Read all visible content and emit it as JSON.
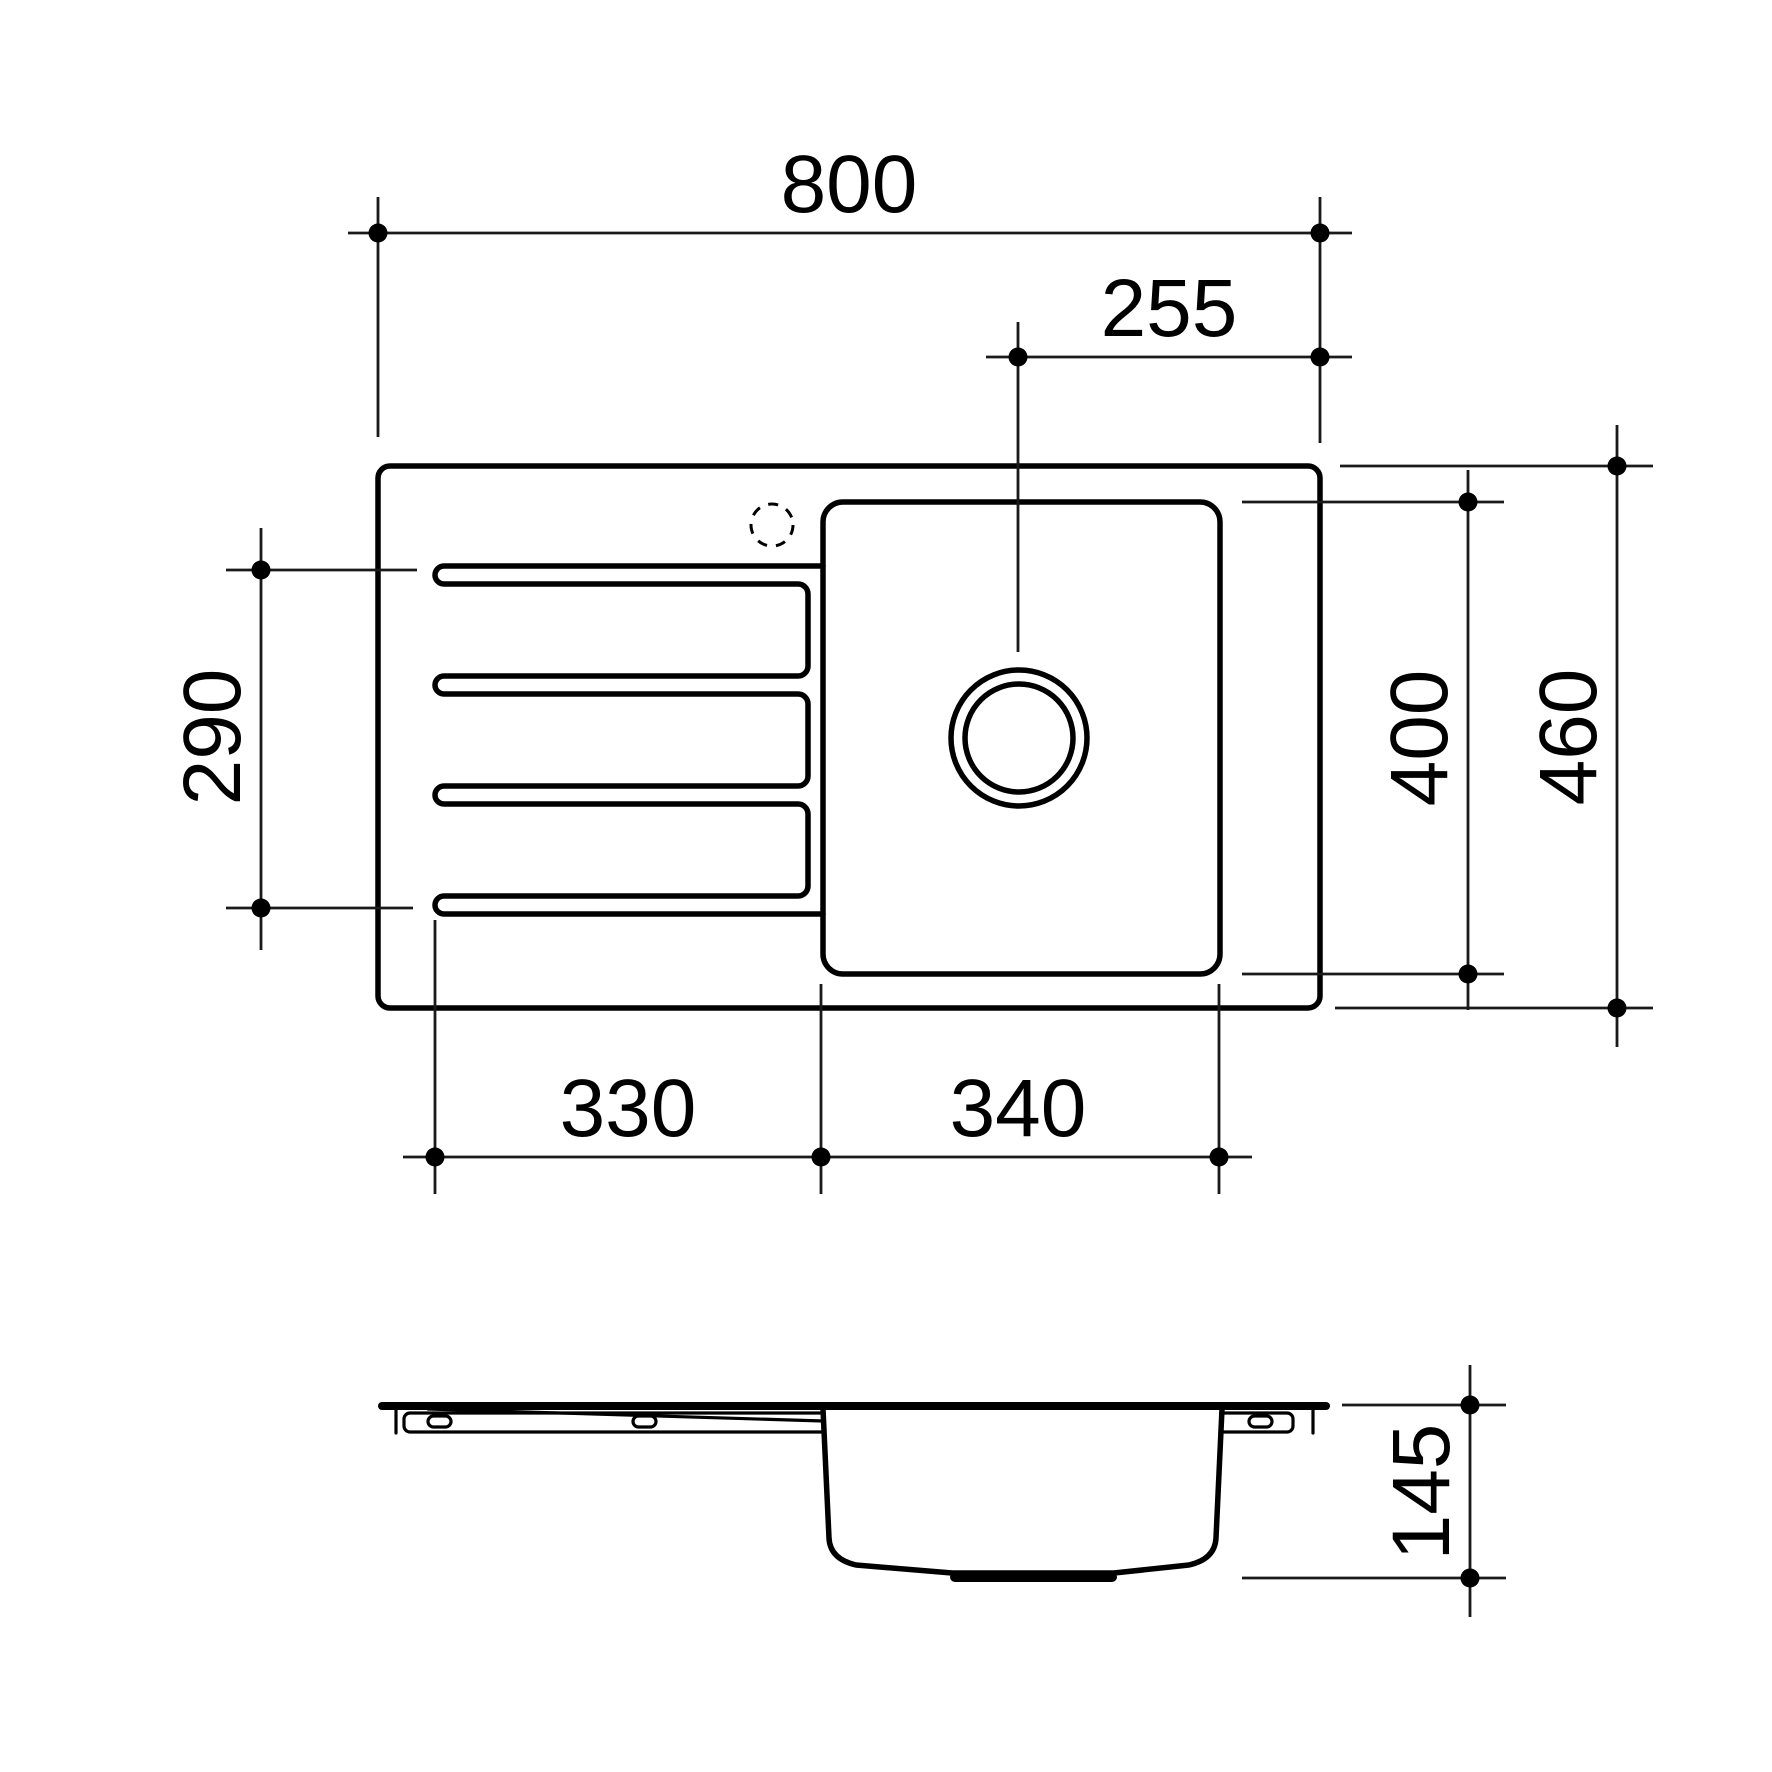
{
  "drawing": {
    "type": "sink-technical-drawing",
    "line_color": "#000000",
    "background_color": "#ffffff",
    "views": {
      "plan": "top view of sink with drainer and bowl",
      "side": "side elevation of sink bowl profile"
    },
    "dimensions": {
      "overall_length": "800",
      "drain_centre_to_edge": "255",
      "groove_span": "290",
      "bowl_length": "400",
      "overall_width": "460",
      "drainer_length": "330",
      "bowl_width": "340",
      "bowl_depth": "145"
    }
  }
}
